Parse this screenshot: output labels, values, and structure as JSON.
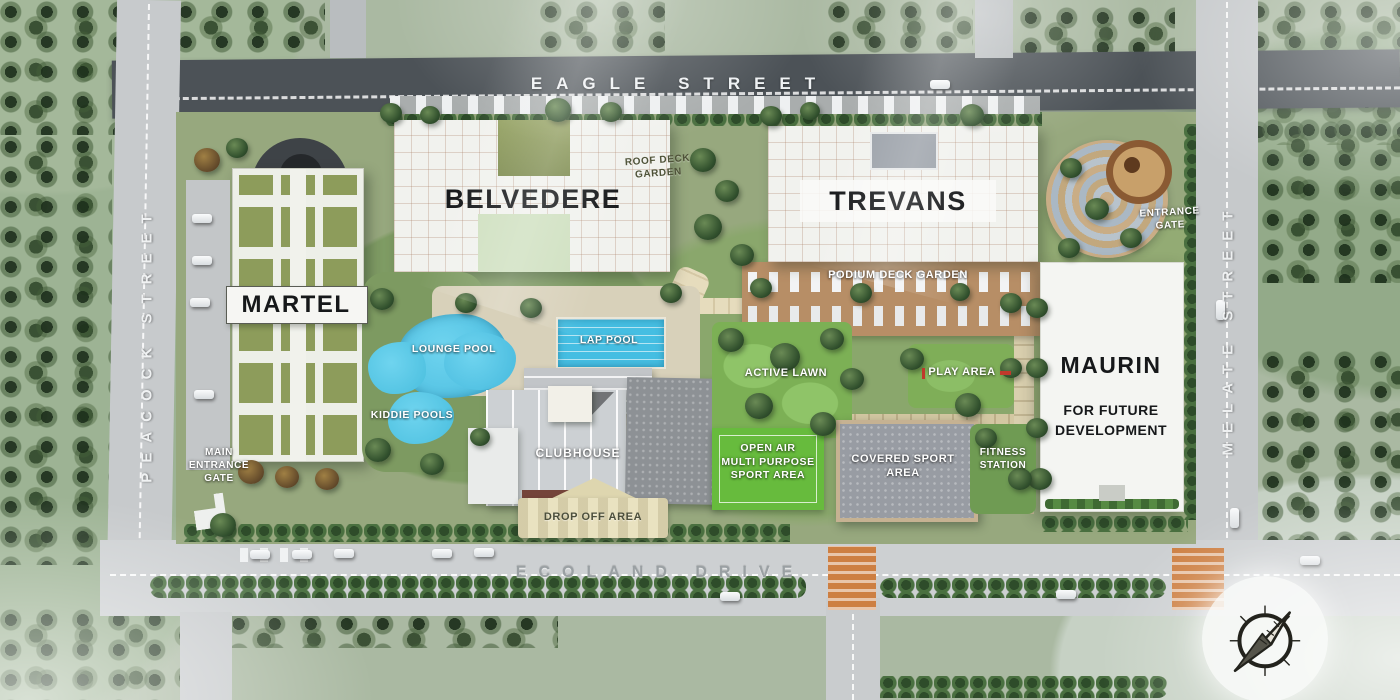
{
  "map": {
    "streets": {
      "eagle": "EAGLE STREET",
      "peacock": "PEACOCK STREET",
      "melate": "MELATE STREET",
      "ecoland": "ECOLAND DRIVE"
    },
    "buildings": {
      "martel": "MARTEL",
      "belvedere": "BELVEDERE",
      "trevans": "TREVANS",
      "maurin": "MAURIN",
      "maurin_note": "FOR FUTURE\nDEVELOPMENT"
    },
    "areas": {
      "roof_deck_garden": "ROOF DECK\nGARDEN",
      "podium_deck_garden": "PODIUM DECK GARDEN",
      "entrance_gate": "ENTRANCE\nGATE",
      "main_entrance_gate": "MAIN\nENTRANCE\nGATE",
      "lounge_pool": "LOUNGE POOL",
      "lap_pool": "LAP POOL",
      "kiddie_pools": "KIDDIE POOLS",
      "clubhouse": "CLUBHOUSE",
      "drop_off_area": "DROP OFF AREA",
      "active_lawn": "ACTIVE LAWN",
      "play_area": "PLAY AREA",
      "open_air_sport_area": "OPEN AIR\nMULTI PURPOSE\nSPORT AREA",
      "covered_sport_area": "COVERED SPORT\nAREA",
      "fitness_station": "FITNESS\nSTATION"
    },
    "icons": {
      "compass": "north-arrow-compass"
    },
    "colors": {
      "pool_blue": "#4fc3e4",
      "court_green": "#67bb3d",
      "lawn_green": "#79b054",
      "roof_olive": "#8d9c5b",
      "road_dark": "#4c5257",
      "road_light": "#cdd0d2",
      "crosswalk_orange": "#cd7f42",
      "building_white": "#f2f3f0"
    }
  }
}
